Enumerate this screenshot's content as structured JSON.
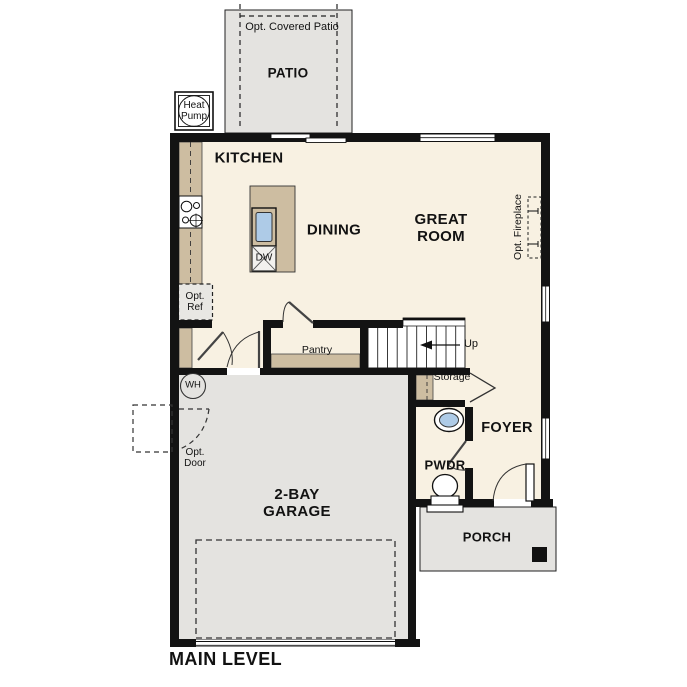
{
  "title": "MAIN LEVEL",
  "colors": {
    "wall": "#131313",
    "floor": "#f8f1e2",
    "concrete": "#e4e3e0",
    "counter": "#cdbda1",
    "sink": "#aecbe7",
    "optional": "#e8e7e3",
    "appliance": "#f2f1ee"
  },
  "rooms": {
    "patio": "PATIO",
    "kitchen": "KITCHEN",
    "dining": "DINING",
    "great_room": "GREAT ROOM",
    "garage": "2-BAY GARAGE",
    "foyer": "FOYER",
    "pwdr": "PWDR",
    "porch": "PORCH"
  },
  "annotations": {
    "opt_covered_patio": "Opt. Covered Patio",
    "heat_pump": "Heat Pump",
    "opt_fireplace": "Opt. Fireplace",
    "opt_ref": "Opt. Ref",
    "pantry": "Pantry",
    "up": "Up",
    "storage": "Storage",
    "wh": "WH",
    "opt_door": "Opt. Door",
    "dw": "DW"
  }
}
